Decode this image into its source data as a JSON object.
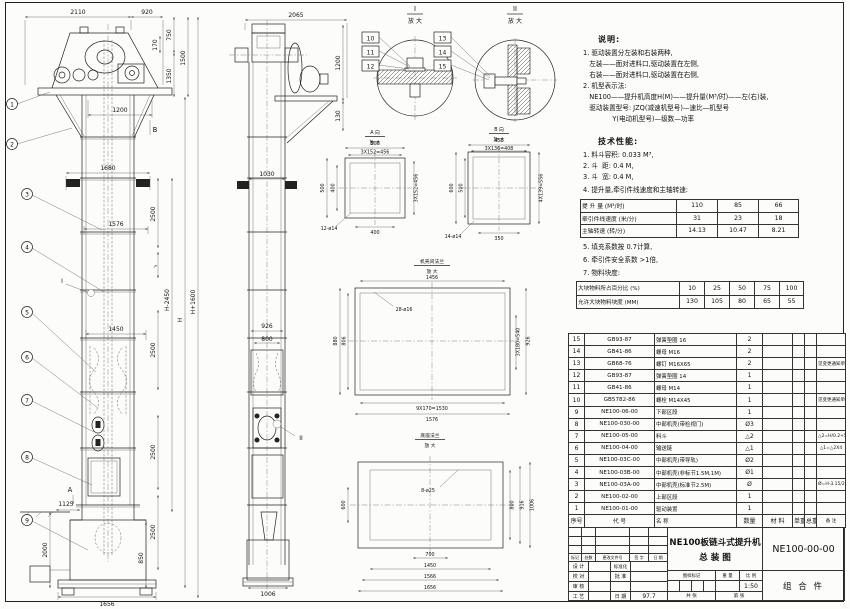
{
  "main_view": {
    "balloons": [
      "1",
      "2",
      "3",
      "4",
      "5",
      "6",
      "7",
      "8",
      "9"
    ],
    "view_marker_a": "A",
    "view_marker_b": "B",
    "detail_marker_i": "I",
    "pitch_mark": "↗",
    "dims": {
      "top1": "2110",
      "top2": "920",
      "head1": "170",
      "head2": "750",
      "head3": "1350",
      "head4": "1500",
      "plat": "1200",
      "bracket": "1680",
      "flange": "1576",
      "mid": "1450",
      "seg1": "2500",
      "seg2": "2500",
      "seg3": "2500",
      "seg4": "2500",
      "boot1": "1125",
      "boot2": "2000",
      "boot3": "850",
      "base": "1656",
      "tall1": "H+1600",
      "tall2": "H-2450",
      "tall3": "H"
    }
  },
  "side_view": {
    "detail_marker_ii": "II",
    "dims": {
      "top": "2065",
      "right1": "1200",
      "right2": "130",
      "width1": "1030",
      "mid1": "926",
      "mid2": "800",
      "base": "1006"
    }
  },
  "detail_i": {
    "title": "I",
    "sub": "放 大",
    "balloons": [
      "10",
      "11",
      "12"
    ]
  },
  "detail_ii": {
    "title": "II",
    "sub": "放 大",
    "balloons": [
      "13",
      "14",
      "15"
    ]
  },
  "view_a": {
    "title": "A 向",
    "sub": "放 大",
    "dims": {
      "top1": "500",
      "top2": "3X152=456",
      "left1": "500",
      "left2": "400",
      "right": "3X152=456",
      "bottom": "400",
      "holes": "12-ø14"
    }
  },
  "view_b": {
    "title": "B 向",
    "sub": "放 大",
    "dims": {
      "top1": "450",
      "top2": "3X136=408",
      "left1": "600",
      "left2": "500",
      "right": "4X139=556",
      "bottom": "350",
      "holes": "14-ø14"
    }
  },
  "flange_detail": {
    "title": "机壳间法兰",
    "sub": "放 大",
    "dims": {
      "top": "1456",
      "holes": "28-ø16",
      "left1": "880",
      "left2": "806",
      "right1": "3X180=540",
      "right2": "926",
      "bottom1": "9X170=1530",
      "bottom2": "1576"
    }
  },
  "base_detail": {
    "title": "底座法兰",
    "sub": "放 大",
    "dims": {
      "holes": "8-ø25",
      "left": "600",
      "right1": "800",
      "right2": "916",
      "right3": "1006",
      "bottom1": "700",
      "bottom2": "1450",
      "bottom3": "1566",
      "bottom4": "1656"
    }
  },
  "notes": {
    "title": "说明:",
    "lines": [
      "1. 驱动装置分左装和右装两种,",
      "   左装——面对进料口,驱动装置在左侧,",
      "   右装——面对进料口,驱动装置在右侧,",
      "2. 机型表示法:",
      "   NE100——提升机高度H(M)——提升量(M³/时)——左(右)装,",
      "   驱动装置型号: JZQ(减速机型号)—速比—机型号",
      "              Y(电动机型号)—级数—功率"
    ]
  },
  "tech": {
    "title": "技术性能:",
    "items_before": [
      "1. 料斗容积: 0.033 M³,",
      "2. 斗  距: 0.4 M,",
      "3. 斗  宽: 0.4 M,",
      "4. 提升量,牵引件线速度和主轴转速:"
    ],
    "items_after": [
      "5. 填充系数按 0.7计算,",
      "6. 牵引件安全系数 >1倍,",
      "7. 物料块度:"
    ]
  },
  "perf_table": {
    "rows": [
      [
        "提 升 量 (M³/时)",
        "110",
        "85",
        "66"
      ],
      [
        "牵引件线速度 (米/分)",
        "31",
        "23",
        "18"
      ],
      [
        "主轴转速 (转/分)",
        "14.13",
        "10.47",
        "8.21"
      ]
    ]
  },
  "lump_table": {
    "rows": [
      [
        "大块物料所占百分比 (%)",
        "10",
        "25",
        "50",
        "75",
        "100"
      ],
      [
        "允许大块物料块度 (MM)",
        "130",
        "105",
        "80",
        "65",
        "55"
      ]
    ]
  },
  "bom": {
    "rows": [
      [
        "15",
        "GB93-87",
        "弹簧垫圈 16",
        "2",
        "",
        "",
        "",
        ""
      ],
      [
        "14",
        "GB41-86",
        "螺母 M16",
        "2",
        "",
        "",
        "",
        ""
      ],
      [
        "13",
        "GB68-76",
        "螺钉 M16X65",
        "2",
        "",
        "",
        "",
        "见变更通知单"
      ],
      [
        "12",
        "GB93-87",
        "弹簧垫圈 14",
        "1",
        "",
        "",
        "",
        ""
      ],
      [
        "11",
        "GB41-86",
        "螺母 M14",
        "1",
        "",
        "",
        "",
        ""
      ],
      [
        "10",
        "GB5782-86",
        "螺栓 M14X45",
        "1",
        "",
        "",
        "",
        "见变更通知单"
      ],
      [
        "9",
        "NE100-06-00",
        "下部区段",
        "1",
        "",
        "",
        "",
        ""
      ],
      [
        "8",
        "NE100-030-00",
        "中部机壳(带检视门)",
        "Ø3",
        "",
        "",
        "",
        ""
      ],
      [
        "7",
        "NE100-05-00",
        "料斗",
        "△2",
        "",
        "",
        "",
        "△2=H/0.2+5.75"
      ],
      [
        "6",
        "NE100-04-00",
        "输送链",
        "△1",
        "",
        "",
        "",
        "△1=△2X4"
      ],
      [
        "5",
        "NE100-03C-00",
        "中部机壳(带导轨)",
        "Ø2",
        "",
        "",
        "",
        ""
      ],
      [
        "4",
        "NE100-03B-00",
        "中部机壳(非标节1.5M,1M)",
        "Ø1",
        "",
        "",
        "",
        ""
      ],
      [
        "3",
        "NE100-03A-00",
        "中部机壳(标准节2.5M)",
        "Ø",
        "",
        "",
        "",
        "Ø=H-3.15/2.5"
      ],
      [
        "2",
        "NE100-02-00",
        "上部区段",
        "1",
        "",
        "",
        "",
        ""
      ],
      [
        "1",
        "NE100-01-00",
        "驱动装置",
        "1",
        "",
        "",
        "",
        ""
      ],
      [
        "序号",
        "代  号",
        "名    称",
        "数量",
        "材  料",
        "单重",
        "总重",
        "备  注"
      ]
    ]
  },
  "title_block": {
    "product_title_1": "NE100板链斗式提升机",
    "product_title_2": "总  装  图",
    "drawing_no": "NE100-00-00",
    "part_class": "组 合 件",
    "rev_cols": [
      "标记",
      "处数",
      "更改文件号",
      "签 字",
      "日 期"
    ],
    "row_design": "设 计",
    "row_check": "校 对",
    "row_review": "审 核",
    "row_process": "工 艺",
    "row_std": "标准化",
    "row_approve": "批 准",
    "row_date_label": "日 期",
    "date": "97.7",
    "mark_label": "图样标记",
    "weight_label": "重 量",
    "scale_label": "比 例",
    "scale": "1:50",
    "sheets_label": "共  张",
    "sheet_label": "第  张"
  }
}
